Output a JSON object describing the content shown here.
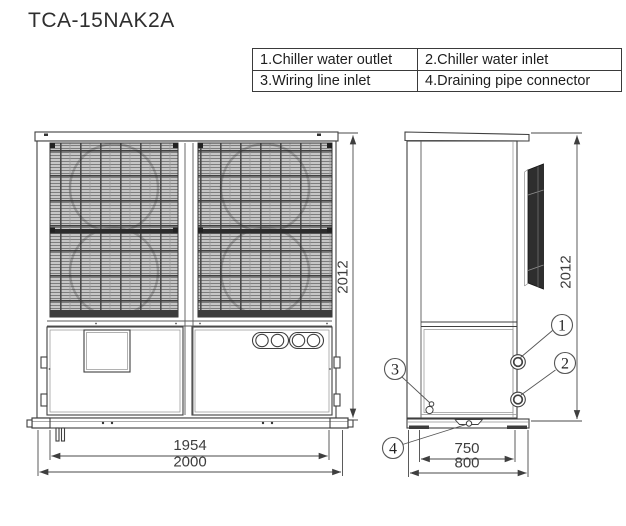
{
  "title": "TCA-15NAK2A",
  "legend": {
    "rows": [
      {
        "cells": [
          "1.Chiller water outlet",
          "2.Chiller water inlet"
        ]
      },
      {
        "cells": [
          "3.Wiring line inlet",
          "4.Draining pipe connector"
        ]
      }
    ]
  },
  "views": {
    "front": {
      "height_label": "2012",
      "inner_width_label": "1954",
      "outer_width_label": "2000"
    },
    "side": {
      "height_label": "2012",
      "inner_depth_label": "750",
      "outer_depth_label": "800"
    }
  },
  "callouts": {
    "one": "1",
    "two": "2",
    "three": "3",
    "four": "4"
  },
  "colors": {
    "line": "#3f3f3f",
    "grille_fill": "#c6c6c6",
    "dark_band": "#2e2e2e",
    "background": "#ffffff"
  }
}
